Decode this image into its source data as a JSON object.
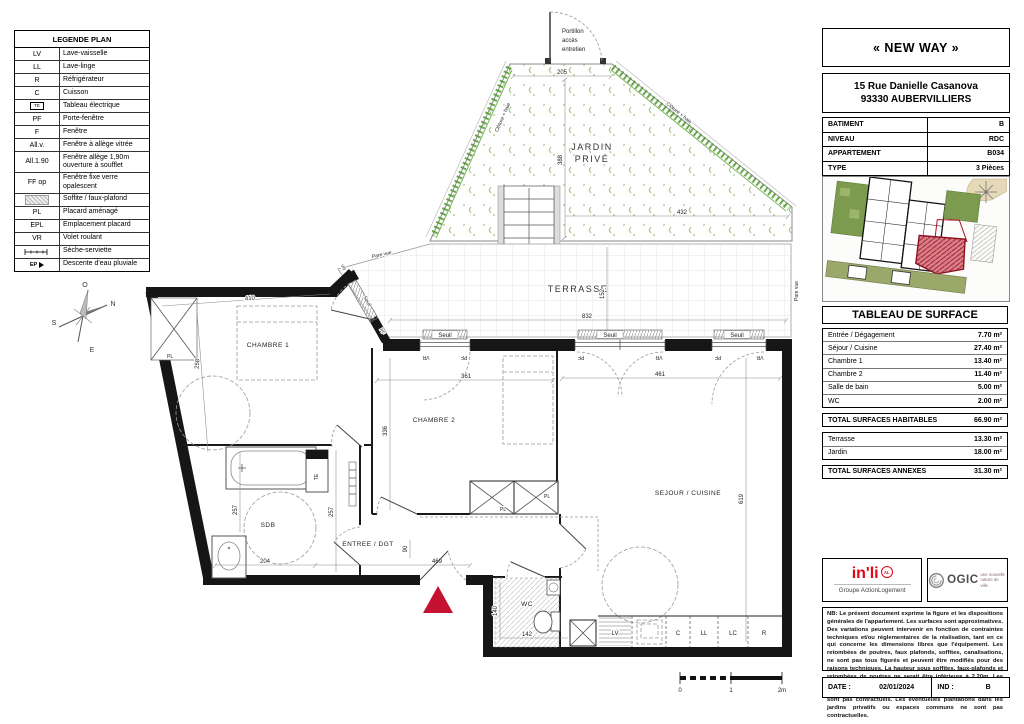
{
  "legend": {
    "title": "LEGENDE PLAN",
    "rows": [
      {
        "sym": "LV",
        "label": "Lave-vaisselle"
      },
      {
        "sym": "LL",
        "label": "Lave-linge"
      },
      {
        "sym": "R",
        "label": "Réfrigérateur"
      },
      {
        "sym": "C",
        "label": "Cuisson"
      },
      {
        "sym": "TE",
        "label": "Tableau électrique"
      },
      {
        "sym": "PF",
        "label": "Porte-fenêtre"
      },
      {
        "sym": "F",
        "label": "Fenêtre"
      },
      {
        "sym": "All.v.",
        "label": "Fenêtre à allège vitrée"
      },
      {
        "sym": "All.1.90",
        "label": "Fenêtre allège 1,90m ouverture à soufflet"
      },
      {
        "sym": "FF op",
        "label": "Fenêtre fixe verre opalescent"
      },
      {
        "sym": "",
        "label": "Soffite / faux-plafond"
      },
      {
        "sym": "PL",
        "label": "Placard aménagé"
      },
      {
        "sym": "EPL",
        "label": "Emplacement placard"
      },
      {
        "sym": "VR",
        "label": "Volet roulant"
      },
      {
        "sym": "",
        "label": "Sèche-serviette"
      },
      {
        "sym": "EP",
        "label": "Descente d'eau pluviale"
      }
    ]
  },
  "plan": {
    "labels": {
      "portillon1": "Portillon",
      "portillon2": "accès",
      "portillon3": "entretien",
      "jardin1": "JARDIN",
      "jardin2": "PRIVÉ",
      "cloture": "Clôture + haie",
      "terrasse": "TERRASSE",
      "pare_vue": "Pare vue",
      "seuil": "Seuil",
      "vr": "VR",
      "pf": "PF",
      "pl": "PL",
      "te": "TE",
      "chambre1": "CHAMBRE 1",
      "chambre2": "CHAMBRE 2",
      "sejour": "SEJOUR / CUISINE",
      "sdb": "SDB",
      "wc": "WC",
      "entree": "ENTREE / DGT"
    },
    "compass": {
      "o": "O",
      "n": "N",
      "s": "S",
      "e": "E"
    },
    "appliances": [
      "LV",
      "C",
      "LL",
      "LC",
      "R"
    ],
    "dims": {
      "garden_top": "205",
      "garden_h": "388",
      "garden_w": "432",
      "terrace_w": "832",
      "terrace_h": "152",
      "ch1_w": "410",
      "ch1_h": "258",
      "ch2_w": "361",
      "ch2_h": "336",
      "sejour_w": "461",
      "sejour_h": "619",
      "sdb_side": "257",
      "sdb_w": "204",
      "entree_w": "469",
      "door_w": "90",
      "wc_w": "142",
      "wc_h": "140"
    },
    "scale": {
      "s0": "0",
      "s1": "1",
      "s2": "2m"
    }
  },
  "panel": {
    "title": "« NEW WAY »",
    "address_1": "15 Rue Danielle Casanova",
    "address_2": "93330 AUBERVILLIERS",
    "info": [
      {
        "label": "BATIMENT",
        "value": "B"
      },
      {
        "label": "NIVEAU",
        "value": "RDC"
      },
      {
        "label": "APPARTEMENT",
        "value": "B034"
      },
      {
        "label": "TYPE",
        "value": "3 Pièces"
      }
    ],
    "surface": {
      "title": "TABLEAU DE SURFACE",
      "rows": [
        [
          "Entrée / Dégagement",
          "7.70 m²"
        ],
        [
          "Séjour / Cuisine",
          "27.40 m²"
        ],
        [
          "Chambre 1",
          "13.40 m²"
        ],
        [
          "Chambre 2",
          "11.40 m²"
        ],
        [
          "Salle de bain",
          "5.00 m²"
        ],
        [
          "WC",
          "2.00 m²"
        ]
      ],
      "total_hab": [
        "TOTAL SURFACES HABITABLES",
        "66.90 m²"
      ],
      "annex_rows": [
        [
          "Terrasse",
          "13.30 m²"
        ],
        [
          "Jardin",
          "18.00 m²"
        ]
      ],
      "total_annex": [
        "TOTAL SURFACES ANNEXES",
        "31.30 m²"
      ]
    },
    "logos": {
      "inli": "in'li",
      "inli_badge": "AL",
      "inli_sub": "Groupe ActionLogement",
      "ogic": "OGIC",
      "ogic_tag_1": "une nouvelle",
      "ogic_tag_2": "nature de ville"
    },
    "legal": "NB: Le présent document exprime la figure et les dispositions générales de l'appartement. Les surfaces sont approximatives. Des variations peuvent intervenir en fonction de contraintes techniques et/ou réglementaires de la réalisation, tant en ce qui concerne les dimensions libres que l'équipement. Les retombées de poutres, faux plafonds, soffites, canalisations, ne sont pas tous figurés et peuvent être modifiés pour des raisons techniques. La hauteur sous soffites, faux-plafonds et retombées de poutres ne serait être inférieure à 2,20m. Les éléments de mobiliers de cuisine et les implantations des équipements électriques sont présentés à titre indicatif et ne sont pas contractuels. Les éventuelles plantations dans les jardins privatifs ou espaces communs ne sont pas contractuelles.",
    "footer": {
      "date_label": "DATE :",
      "date": "02/01/2024",
      "ind_label": "IND :",
      "ind": "B"
    }
  },
  "colors": {
    "wall": "#161616",
    "entrance_marker": "#c41230",
    "hedge_green": "#4e9a2e",
    "site_green": "#7d9b4e",
    "unit_red": "#c84a55",
    "inli_red": "#e30613"
  }
}
